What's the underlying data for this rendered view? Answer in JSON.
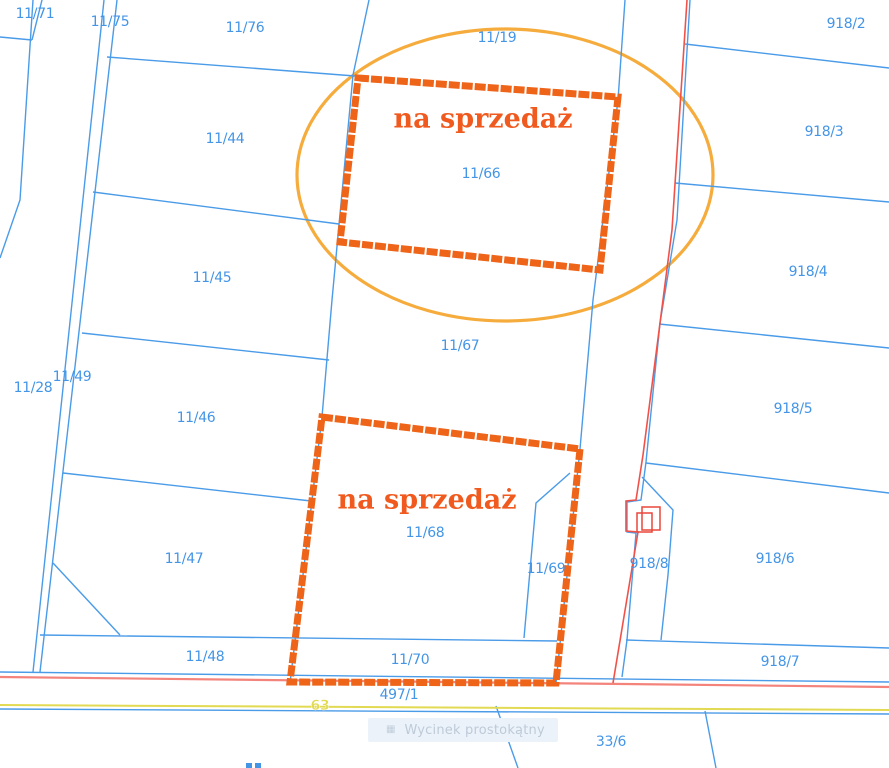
{
  "map": {
    "width": 889,
    "height": 768,
    "colors": {
      "parcel_line_blue": "#4A9BE8",
      "parcel_label_blue": "#4495E6",
      "sale_outline_orange": "#EE6418",
      "sale_text_orange": "#F05A1E",
      "highlight_ellipse_orange": "#F6AC3C",
      "road_line_red": "#F0524A",
      "road_line_salmon": "#F4837C",
      "road_line_yellow": "#E2DA52",
      "building_red": "#E8473B",
      "watermark_bg": "#EBF2FA",
      "watermark_text": "#9FB0C0"
    },
    "parcel_labels": [
      {
        "text": "11/71",
        "x": 35,
        "y": 13
      },
      {
        "text": "11/75",
        "x": 110,
        "y": 21
      },
      {
        "text": "11/76",
        "x": 245,
        "y": 27
      },
      {
        "text": "11/19",
        "x": 497,
        "y": 37
      },
      {
        "text": "918/2",
        "x": 846,
        "y": 23
      },
      {
        "text": "11/44",
        "x": 225,
        "y": 138
      },
      {
        "text": "918/3",
        "x": 824,
        "y": 131
      },
      {
        "text": "11/66",
        "x": 481,
        "y": 173
      },
      {
        "text": "11/45",
        "x": 212,
        "y": 277
      },
      {
        "text": "918/4",
        "x": 808,
        "y": 271
      },
      {
        "text": "11/67",
        "x": 460,
        "y": 345
      },
      {
        "text": "11/49",
        "x": 72,
        "y": 376
      },
      {
        "text": "11/28",
        "x": 33,
        "y": 387
      },
      {
        "text": "918/5",
        "x": 793,
        "y": 408
      },
      {
        "text": "11/46",
        "x": 196,
        "y": 417
      },
      {
        "text": "11/68",
        "x": 425,
        "y": 532
      },
      {
        "text": "11/47",
        "x": 184,
        "y": 558
      },
      {
        "text": "11/69",
        "x": 546,
        "y": 568
      },
      {
        "text": "918/8",
        "x": 649,
        "y": 563
      },
      {
        "text": "918/6",
        "x": 775,
        "y": 558
      },
      {
        "text": "11/48",
        "x": 205,
        "y": 656
      },
      {
        "text": "11/70",
        "x": 410,
        "y": 659
      },
      {
        "text": "918/7",
        "x": 780,
        "y": 661
      },
      {
        "text": "497/1",
        "x": 399,
        "y": 694
      },
      {
        "text": "33/6",
        "x": 611,
        "y": 741
      }
    ],
    "road_number_label": {
      "text": "63",
      "x": 320,
      "y": 705
    },
    "sale_overlays": [
      {
        "label": "na sprzedaż",
        "polygon": [
          [
            358,
            78
          ],
          [
            618,
            97
          ],
          [
            600,
            270
          ],
          [
            340,
            242
          ]
        ]
      },
      {
        "label": "na sprzedaż",
        "polygon": [
          [
            322,
            417
          ],
          [
            580,
            449
          ],
          [
            556,
            683
          ],
          [
            290,
            682
          ]
        ]
      }
    ],
    "highlight_ellipse": {
      "cx": 505,
      "cy": 175,
      "rx": 208,
      "ry": 146
    },
    "blue_lines": [
      [
        [
          33,
          0
        ],
        [
          20,
          200
        ],
        [
          0,
          258
        ]
      ],
      [
        [
          42,
          0
        ],
        [
          32,
          40
        ]
      ],
      [
        [
          0,
          37
        ],
        [
          32,
          40
        ]
      ],
      [
        [
          104,
          0
        ],
        [
          33,
          672
        ]
      ],
      [
        [
          117,
          0
        ],
        [
          40,
          672
        ]
      ],
      [
        [
          107,
          57
        ],
        [
          355,
          76
        ]
      ],
      [
        [
          93,
          192
        ],
        [
          339,
          224
        ]
      ],
      [
        [
          82,
          333
        ],
        [
          329,
          360
        ]
      ],
      [
        [
          63,
          473
        ],
        [
          311,
          501
        ]
      ],
      [
        [
          53,
          563
        ],
        [
          120,
          635
        ]
      ],
      [
        [
          40,
          635
        ],
        [
          557,
          641
        ]
      ],
      [
        [
          369,
          0
        ],
        [
          353,
          75
        ],
        [
          332,
          300
        ],
        [
          322,
          417
        ],
        [
          290,
          683
        ]
      ],
      [
        [
          625,
          0
        ],
        [
          618,
          100
        ],
        [
          593,
          300
        ],
        [
          580,
          449
        ],
        [
          556,
          683
        ]
      ],
      [
        [
          690,
          0
        ],
        [
          677,
          220
        ],
        [
          660,
          323
        ],
        [
          646,
          462
        ],
        [
          641,
          500
        ],
        [
          627,
          502
        ],
        [
          627,
          532
        ],
        [
          636,
          533
        ],
        [
          627,
          640
        ],
        [
          622,
          677
        ]
      ],
      [
        [
          642,
          477
        ],
        [
          673,
          510
        ],
        [
          668,
          575
        ],
        [
          661,
          640
        ]
      ],
      [
        [
          570,
          473
        ],
        [
          536,
          503
        ],
        [
          524,
          638
        ]
      ],
      [
        [
          685,
          44
        ],
        [
          889,
          68
        ]
      ],
      [
        [
          675,
          183
        ],
        [
          889,
          202
        ]
      ],
      [
        [
          659,
          324
        ],
        [
          889,
          348
        ]
      ],
      [
        [
          646,
          463
        ],
        [
          889,
          493
        ]
      ],
      [
        [
          626,
          640
        ],
        [
          889,
          648
        ]
      ],
      [
        [
          0,
          672
        ],
        [
          889,
          682
        ]
      ],
      [
        [
          0,
          709
        ],
        [
          889,
          714
        ]
      ],
      [
        [
          496,
          706
        ],
        [
          518,
          768
        ]
      ],
      [
        [
          705,
          711
        ],
        [
          716,
          768
        ]
      ]
    ],
    "red_lines": [
      [
        [
          687,
          0
        ],
        [
          672,
          230
        ],
        [
          643,
          455
        ],
        [
          636,
          500
        ],
        [
          626,
          501
        ],
        [
          626,
          531
        ],
        [
          638,
          532
        ],
        [
          613,
          683
        ]
      ]
    ],
    "salmon_lines": [
      [
        [
          0,
          677
        ],
        [
          889,
          687
        ]
      ]
    ],
    "yellow_lines": [
      [
        [
          0,
          705
        ],
        [
          889,
          710
        ]
      ]
    ],
    "buildings": [
      {
        "x": 642,
        "y": 507,
        "w": 18,
        "h": 23
      },
      {
        "x": 637,
        "y": 513,
        "w": 15,
        "h": 19
      }
    ],
    "clipped_label_marks": [
      [
        246,
        763
      ],
      [
        255,
        763
      ]
    ],
    "watermark": {
      "text": "Wycinek prostokątny",
      "icon": "crop-icon"
    }
  }
}
